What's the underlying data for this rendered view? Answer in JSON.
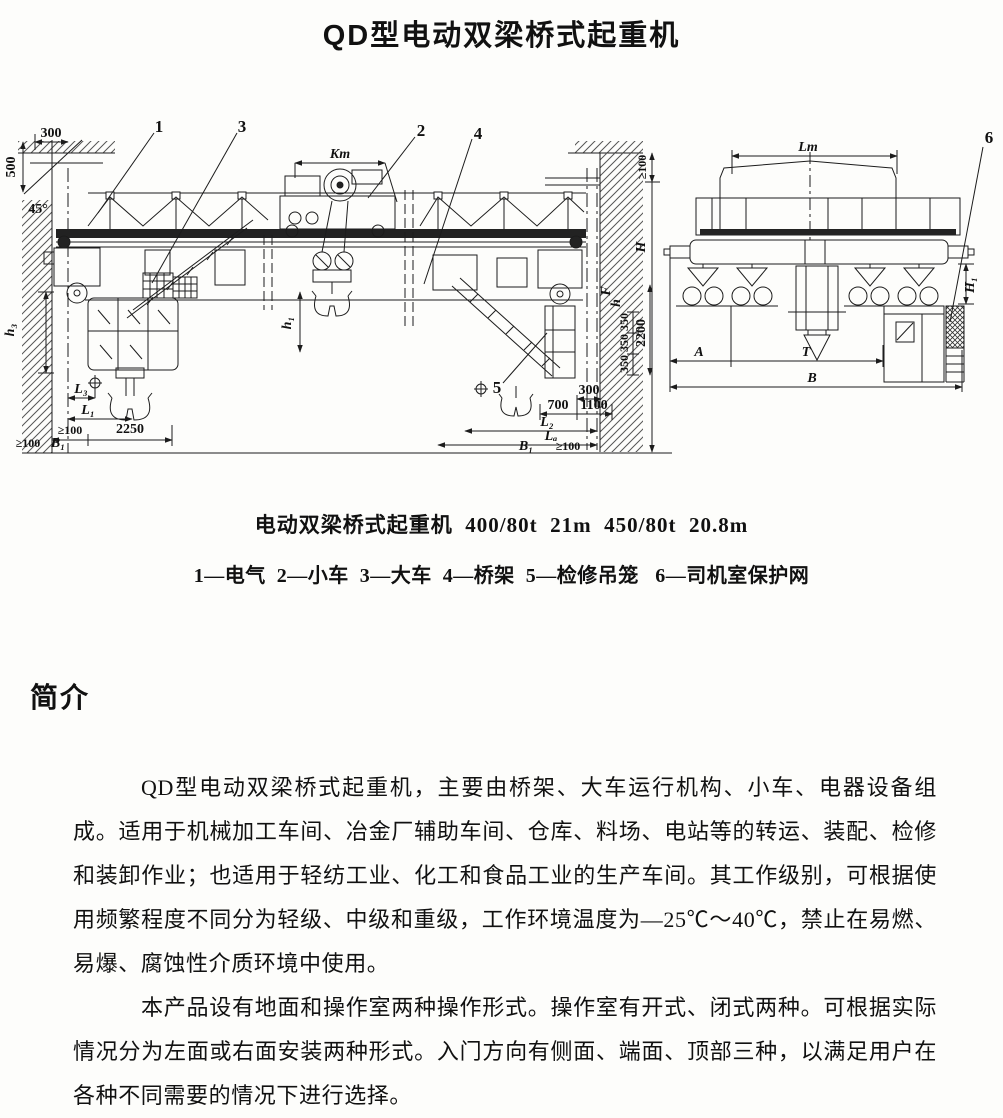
{
  "page": {
    "title": "QD型电动双梁桥式起重机"
  },
  "figure": {
    "caption": "电动双梁桥式起重机  400/80t  21m  450/80t  20.8m",
    "legend": "1—电气  2—小车  3—大车  4—桥架  5—检修吊笼   6—司机室保护网",
    "callouts": {
      "c1": "1",
      "c2": "2",
      "c3": "3",
      "c4": "4",
      "c5": "5",
      "c6": "6"
    },
    "dims": {
      "d300": "300",
      "d500": "500",
      "a45": "45°",
      "kt": "Kт",
      "ge100": "≥100",
      "H": "H",
      "h1": "h₁",
      "h3": "h₃",
      "hs": "h",
      "F": "F",
      "L1": "L₁",
      "L2": "L₂",
      "L3": "L₃",
      "LA": "Lₐ",
      "B1": "B₁",
      "d2250": "2250",
      "d700": "700",
      "d1100": "1100",
      "d350": "350",
      "d2200": "2200",
      "Lt": "Lт",
      "H1": "H₁",
      "A": "A",
      "T": "T",
      "B": "B"
    }
  },
  "section": {
    "heading": "简介"
  },
  "body": {
    "p1": "QD型电动双梁桥式起重机，主要由桥架、大车运行机构、小车、电器设备组成。适用于机械加工车间、冶金厂辅助车间、仓库、料场、电站等的转运、装配、检修和装卸作业；也适用于轻纺工业、化工和食品工业的生产车间。其工作级别，可根据使用频繁程度不同分为轻级、中级和重级，工作环境温度为—25℃～40℃，禁止在易燃、易爆、腐蚀性介质环境中使用。",
    "p2": "本产品设有地面和操作室两种操作形式。操作室有开式、闭式两种。可根据实际情况分为左面或右面安装两种形式。入门方向有侧面、端面、顶部三种，以满足用户在各种不同需要的情况下进行选择。"
  }
}
